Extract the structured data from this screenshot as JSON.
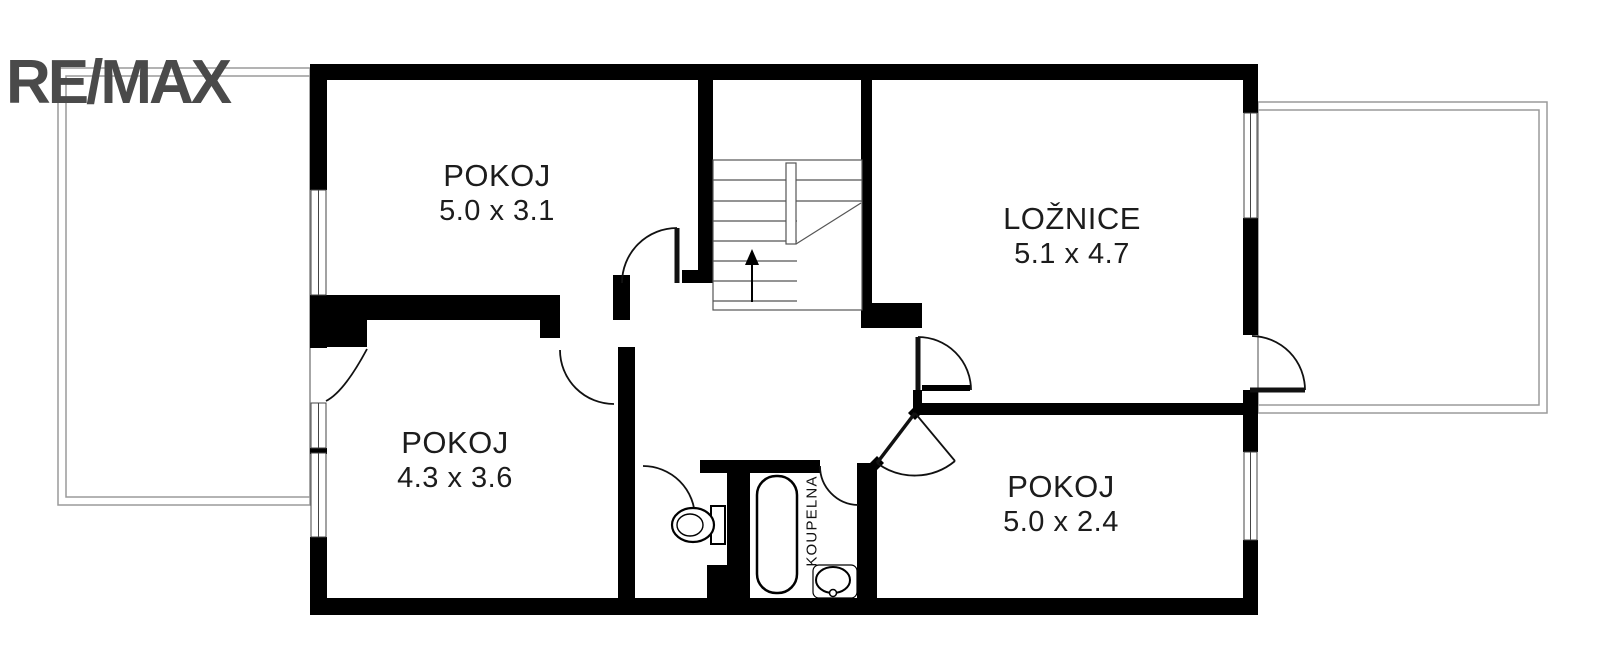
{
  "branding": {
    "logo_text": "RE/MAX"
  },
  "rooms": [
    {
      "name": "POKOJ",
      "dimensions": "5.0 x 3.1"
    },
    {
      "name": "LOŽNICE",
      "dimensions": "5.1 x 4.7"
    },
    {
      "name": "POKOJ",
      "dimensions": "4.3 x 3.6"
    },
    {
      "name": "POKOJ",
      "dimensions": "5.0 x 2.4"
    },
    {
      "name": "KOUPELNA"
    }
  ],
  "colors": {
    "walls": "#000000",
    "logo": "#4a4a4a",
    "thin_lines": "#555555",
    "balcony_outline": "#9a9a9a",
    "label_text": "#1c1c1c",
    "background": "#ffffff"
  }
}
